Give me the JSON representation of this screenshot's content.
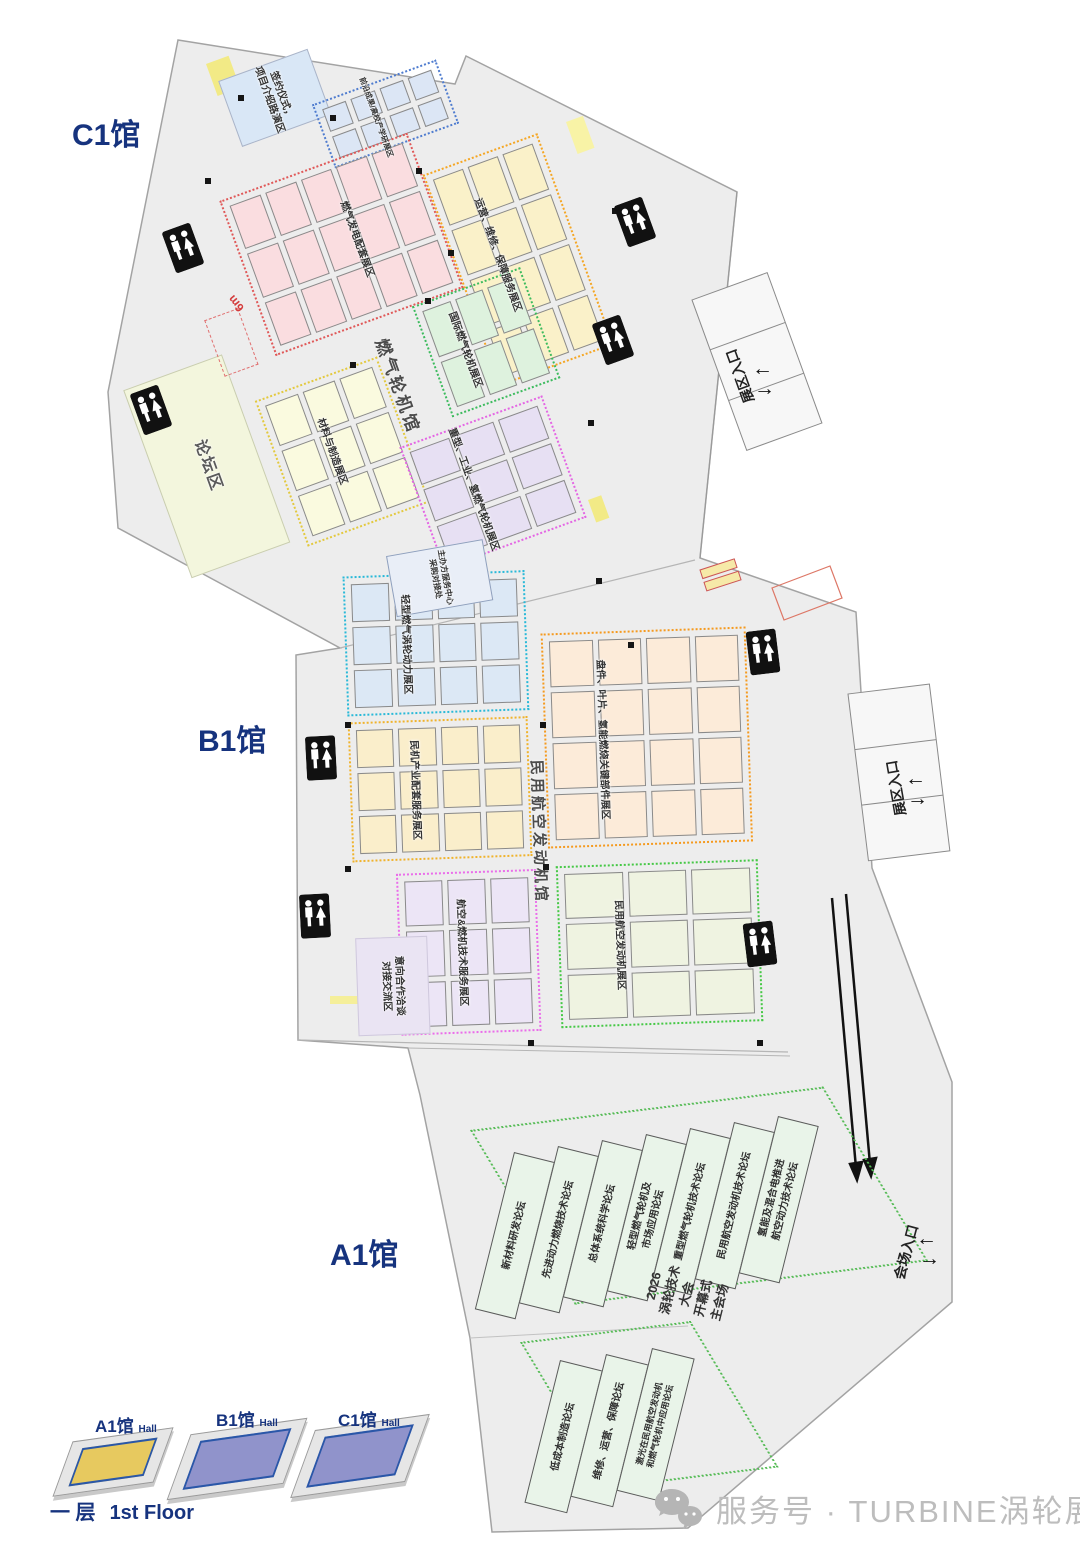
{
  "halls": {
    "c1": {
      "label": "C1馆"
    },
    "b1": {
      "label": "B1馆"
    },
    "a1": {
      "label": "A1馆"
    }
  },
  "streets": {
    "c1": "燃气轮机馆",
    "b1": "民用航空发动机馆"
  },
  "zones_c1": {
    "sign_area": {
      "label": "签约仪式，\n项目介绍路演区"
    },
    "frontier": {
      "label": "前沿成果/高校产学研展区",
      "grid": [
        4,
        2
      ]
    },
    "power_supporting": {
      "label": "燃气发电配套展区",
      "grid": [
        5,
        3
      ]
    },
    "operations": {
      "label": "运营、维修、保障服务展区",
      "grid": [
        3,
        4
      ]
    },
    "intl_turbine": {
      "label": "国际燃气轮机展区",
      "grid": [
        3,
        2
      ]
    },
    "forum_area": {
      "label": "论坛区"
    },
    "materials": {
      "label": "材料与制造展区",
      "grid": [
        3,
        3
      ]
    },
    "heavy_industrial": {
      "label": "重型、工业、氢燃气轮机展区",
      "grid": [
        3,
        3
      ]
    }
  },
  "zones_b1": {
    "light_turbine": {
      "label": "轻型燃气涡轮动力展区",
      "grid": [
        4,
        3
      ]
    },
    "civil_supporting": {
      "label": "民机产业配套服务展区",
      "grid": [
        4,
        3
      ]
    },
    "key_parts": {
      "label": "盘件、叶片、氢能燃烧关键部件展区",
      "grid": [
        4,
        4
      ]
    },
    "negotiation": {
      "label": "意向合作洽谈\n对接交流区"
    },
    "tech_service": {
      "label": "航空&燃机技术服务展区",
      "grid": [
        3,
        3
      ]
    },
    "civil_engine": {
      "label": "民用航空发动机展区",
      "grid": [
        3,
        3
      ]
    },
    "service_center": {
      "label": "主办方服务中心\n采购对接处"
    }
  },
  "a1": {
    "forums": [
      "新材料研发论坛",
      "先进动力燃烧技术论坛",
      "总体系统科学论坛",
      "轻型燃气轮机及\n市场应用论坛",
      "重型燃气轮机技术论坛",
      "民用航空发动机技术论坛",
      "氢能及混合电推进\n航空动力技术论坛"
    ],
    "conference": "2026\n涡轮技术\n大会\n开幕式\n主会场",
    "annex_forums": [
      "低成本制造论坛",
      "维修、运营、保障论坛",
      "激光在民用航空发动机\n和燃气轮机中应用论坛"
    ]
  },
  "entrances": {
    "exhibition": "展区入口",
    "venue": "会场入口",
    "arrow_left": "←",
    "arrow_right": "→"
  },
  "fire_lane": "6m",
  "legend": {
    "blocks": [
      {
        "name": "A1馆",
        "tag": "Hall"
      },
      {
        "name": "B1馆",
        "tag": "Hall"
      },
      {
        "name": "C1馆",
        "tag": "Hall"
      }
    ],
    "floor_cn": "一 层",
    "floor_en": "1st Floor"
  },
  "watermark": "服务号 · TURBINE涡轮展",
  "colors": {
    "sign_bg": "#d9e7f6",
    "frontier_border": "#4f7ccf",
    "frontier_fill": "#dce6f5",
    "pink_border": "#e05858",
    "pink_fill": "#fadde0",
    "c1orange_border": "#f5a623",
    "c1orange_fill": "#faf1c9",
    "c1green_border": "#3dbb5e",
    "c1green_fill": "#def2de",
    "forum_bg": "#f3f6dd",
    "materials_border": "#e3c93e",
    "materials_fill": "#fafadf",
    "heavy_border": "#e466e4",
    "heavy_fill": "#e7e0f3",
    "cyan_border": "#29b9d8",
    "cyan_fill": "#dce8f5",
    "b1yellow_border": "#f0b32c",
    "b1yellow_fill": "#faeecb",
    "parts_border": "#f59a1f",
    "parts_fill": "#fcebd9",
    "magenta_border": "#ea6dea",
    "magenta_fill": "#ece5f6",
    "b1green_border": "#46c846",
    "b1green_fill": "#eff3e1",
    "negotiation_bg": "#eae4f3",
    "a1_zone_border": "#55bb55",
    "a1_hall_fill": "#e9f4e9",
    "legend_a1_face": "#e7c95f",
    "legend_b1_face": "#9093cb",
    "legend_c1_face": "#9093cb",
    "hall_title": "#16337e"
  }
}
